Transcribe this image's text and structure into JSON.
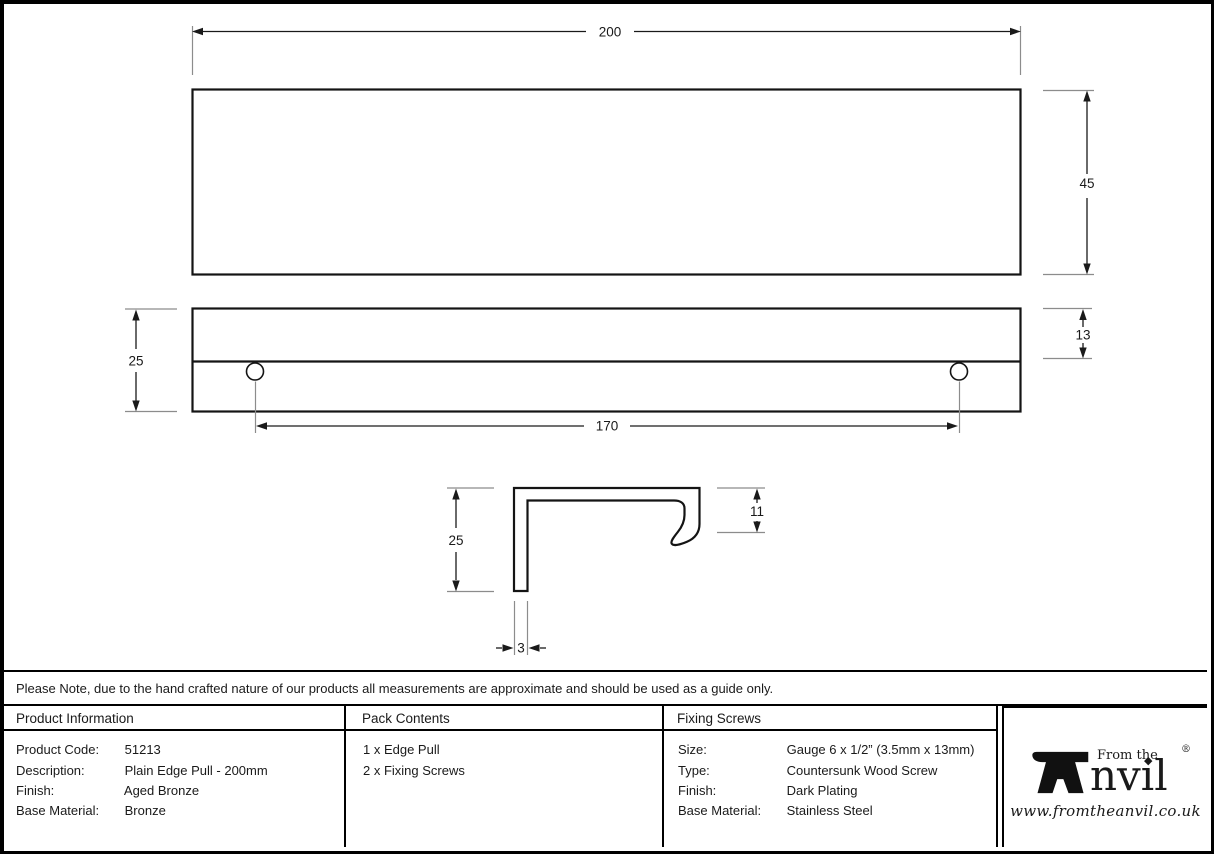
{
  "drawing": {
    "labels": {
      "overall_width": "200",
      "face_height": "45",
      "edge_height": "25",
      "lip_height": "13",
      "hole_spacing": "170",
      "profile_height": "25",
      "hook_depth": "11",
      "material_thickness": "3"
    }
  },
  "note": "Please Note, due to the hand crafted nature of our products all measurements are approximate and should be used as a guide only.",
  "product_information": {
    "header": "Product Information",
    "rows": [
      {
        "label": "Product Code:",
        "value": "51213"
      },
      {
        "label": "Description:",
        "value": "Plain Edge Pull - 200mm"
      },
      {
        "label": "Finish:",
        "value": "Aged Bronze"
      },
      {
        "label": "Base Material:",
        "value": "Bronze"
      }
    ]
  },
  "pack_contents": {
    "header": "Pack Contents",
    "items": [
      "1 x Edge Pull",
      "2 x Fixing Screws"
    ]
  },
  "fixing_screws": {
    "header": "Fixing Screws",
    "rows": [
      {
        "label": "Size:",
        "value": "Gauge 6 x 1/2” (3.5mm x 13mm)"
      },
      {
        "label": "Type:",
        "value": "Countersunk Wood Screw"
      },
      {
        "label": "Finish:",
        "value": "Dark Plating"
      },
      {
        "label": "Base Material:",
        "value": "Stainless Steel"
      }
    ]
  },
  "logo": {
    "from_the": "From the",
    "wordmark": "nvıl",
    "i_dot": "◆",
    "registered": "®",
    "url": "www.fromtheanvil.co.uk"
  },
  "colors": {
    "line": "#1a1a1a",
    "extension_line": "#8c8c8c",
    "background": "#ffffff"
  }
}
